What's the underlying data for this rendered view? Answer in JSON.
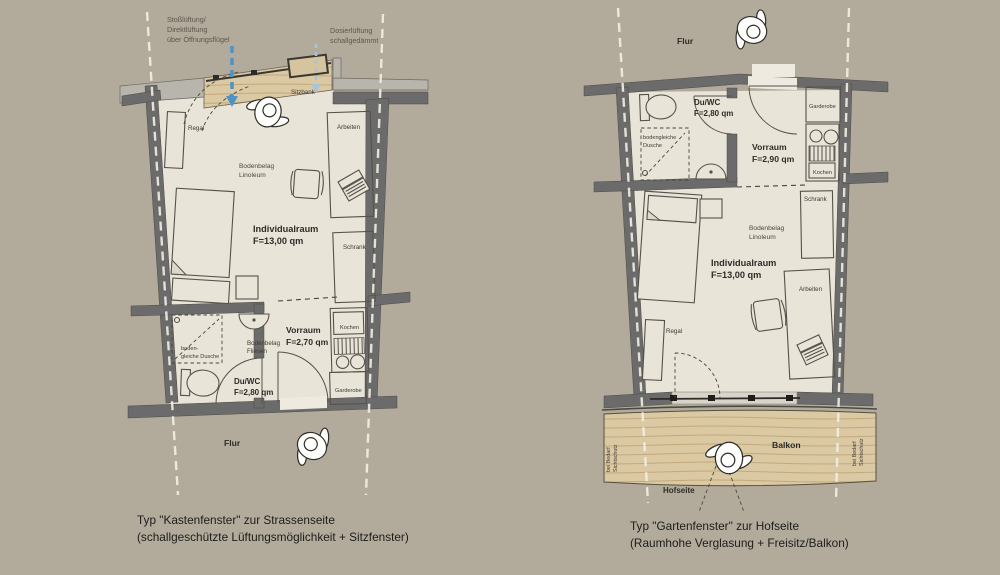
{
  "colors": {
    "background": "#b2ab9c",
    "floor": "#e9e4d8",
    "wall": "#6b6b6b",
    "wood": "#dbc9a3",
    "ventilation_arrow_blue": "#4e92c6",
    "ventilation_arrow_lightblue": "#a7c4da"
  },
  "left_plan": {
    "ann_stoss_1": "Stoßlüftung/",
    "ann_stoss_2": "Direktlüftung",
    "ann_stoss_3": "über Öffnungsflügel",
    "ann_dosier_1": "Dosierlüftung",
    "ann_dosier_2": "schallgedämmt",
    "sitzbank": "Sitzbank",
    "regal": "Regal",
    "arbeiten": "Arbeiten",
    "bodenbelag_1": "Bodenbelag",
    "bodenbelag_2": "Linoleum",
    "individualraum_1": "Individualraum",
    "individualraum_2": "F=13,00 qm",
    "schrank": "Schrank",
    "dusche_1": "boden-",
    "dusche_2": "gleiche Dusche",
    "fliesen_1": "Bodenbelag",
    "fliesen_2": "Fliesen",
    "duwc_1": "Du/WC",
    "duwc_2": "F=2,80 qm",
    "vorraum_1": "Vorraum",
    "vorraum_2": "F=2,70 qm",
    "kochen": "Kochen",
    "garderobe": "Garderobe",
    "flur": "Flur",
    "caption_1": "Typ \"Kastenfenster\" zur Strassenseite",
    "caption_2": "(schallgeschützte Lüftungsmöglichkeit + Sitzfenster)"
  },
  "right_plan": {
    "flur": "Flur",
    "duwc_1": "Du/WC",
    "duwc_2": "F=2,80 qm",
    "garderobe": "Garderobe",
    "dusche_1": "bodengleiche",
    "dusche_2": "Dusche",
    "vorraum_1": "Vorraum",
    "vorraum_2": "F=2,90 qm",
    "kochen": "Kochen",
    "schrank": "Schrank",
    "bodenbelag_1": "Bodenbelag",
    "bodenbelag_2": "Linoleum",
    "individualraum_1": "Individualraum",
    "individualraum_2": "F=13,00 qm",
    "arbeiten": "Arbeiten",
    "regal": "Regal",
    "balkon": "Balkon",
    "sichtschutz_1": "bei Bedarf",
    "sichtschutz_2": "Sichtschutz",
    "hofseite": "Hofseite",
    "caption_1": "Typ \"Gartenfenster\" zur Hofseite",
    "caption_2": "(Raumhohe Verglasung + Freisitz/Balkon)"
  }
}
